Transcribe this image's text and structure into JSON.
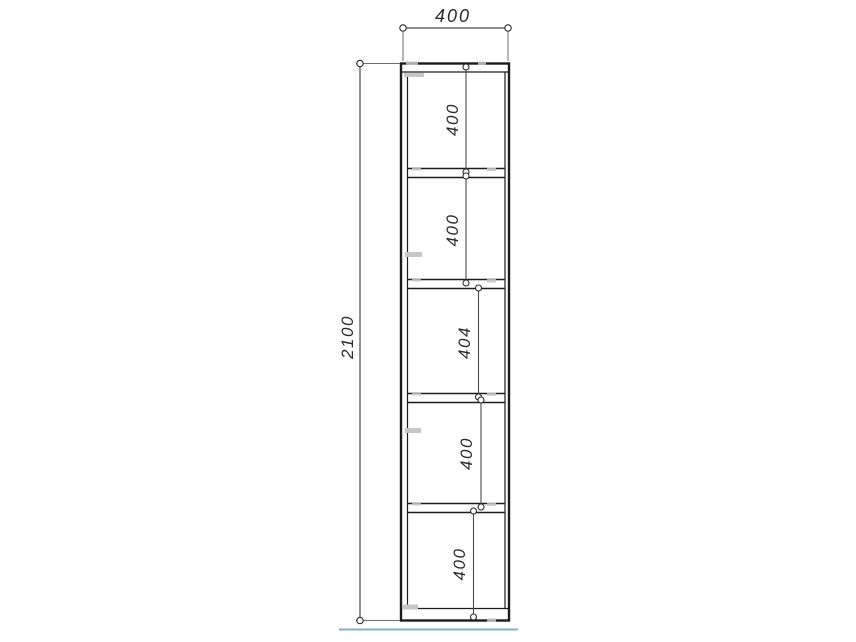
{
  "drawing": {
    "type": "furniture-technical-drawing",
    "overall": {
      "width_label": "400",
      "height_label": "2100"
    },
    "compartment_labels": [
      "400",
      "400",
      "404",
      "400",
      "400"
    ],
    "colors": {
      "outline": "#1c1c1c",
      "dimension_line": "#4a4a4a",
      "extension_line": "#6e6e6e",
      "floor_line": "#83b2d0",
      "fitting_mark": "#c6c6c6",
      "text": "#2a2a2a"
    }
  }
}
